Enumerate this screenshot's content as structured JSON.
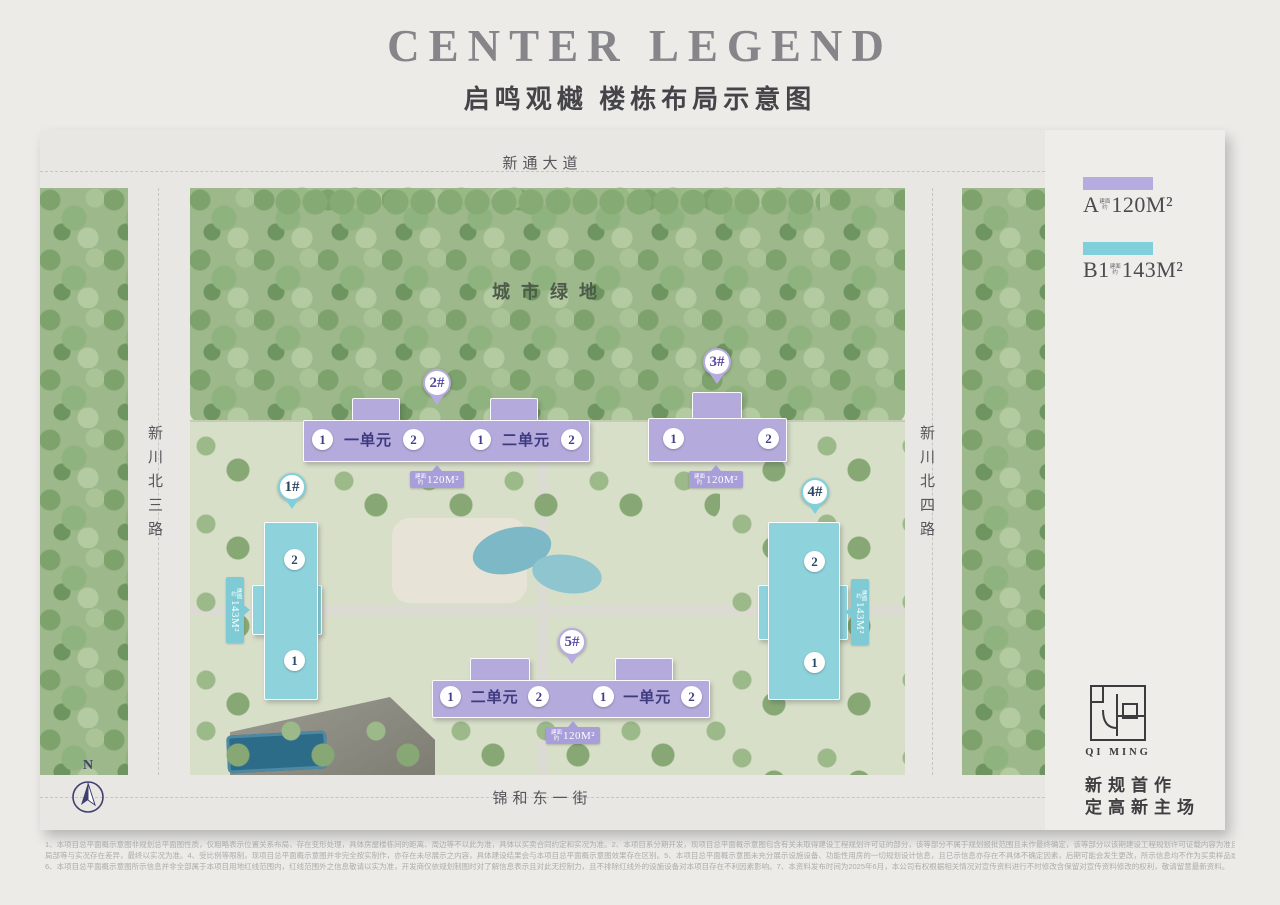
{
  "header": {
    "title": "CENTER LEGEND",
    "subtitle": "启鸣观樾 楼栋布局示意图"
  },
  "roads": {
    "top": "新通大道",
    "left": "新川北三路",
    "right": "新川北四路",
    "bottom": "锦和东一街"
  },
  "map": {
    "green_area_label": "城市绿地",
    "compass": "N"
  },
  "legend": {
    "items": [
      {
        "code": "A",
        "prefix": "建面约",
        "area": "120M²",
        "color": "#b6acdf"
      },
      {
        "code": "B1",
        "prefix": "建面约",
        "area": "143M²",
        "color": "#80cfda"
      }
    ]
  },
  "buildings": {
    "b1": {
      "id": "1#",
      "type": "B1",
      "unit_top": "2",
      "unit_bottom": "1",
      "tag_prefix": "建面约",
      "tag_area": "143M²"
    },
    "b2": {
      "id": "2#",
      "type": "A",
      "cells": [
        "1",
        "一单元",
        "2",
        "1",
        "二单元",
        "2"
      ],
      "tag_prefix": "建面约",
      "tag_area": "120M²"
    },
    "b3": {
      "id": "3#",
      "type": "A",
      "unit_left": "1",
      "unit_right": "2",
      "tag_prefix": "建面约",
      "tag_area": "120M²"
    },
    "b4": {
      "id": "4#",
      "type": "B1",
      "unit_top": "2",
      "unit_bottom": "1",
      "tag_prefix": "建面约",
      "tag_area": "143M²"
    },
    "b5": {
      "id": "5#",
      "type": "A",
      "cells": [
        "1",
        "二单元",
        "2",
        "1",
        "一单元",
        "2"
      ],
      "tag_prefix": "建面约",
      "tag_area": "120M²"
    }
  },
  "branding": {
    "logo_text": "QI MING",
    "slogan_line1": "新规首作",
    "slogan_line2": "定高新主场"
  },
  "disclaimer": {
    "lines": [
      "1、本项目总平面概示意图非规划总平面图性质，仅粗略表示位置关系布局，存在变形处理，具体房屋楼栋间的距离、周边等不以此为准，具体以买卖合同约定和实况为准。2、本项目系分期开发，现项目总平面概示意图包含有关未取得建设工程规划许可证的部分，该等部分不属于规划报批范围且未作最终确定，该等部分以该期建设工程规划许可证载内容为准且项目总平面概示意图亦会发生变化。3、建筑、景观等任何已经展示内容的细节、色彩、",
      "局部等与实况存在差异，最终以实况为准。4、受比例等限制，现项目总平面概示意图并非完全按实制作，亦存在未尽展示之内容，具体建设结果会与本项目总平面概示意图效果存在区别。5、本项目总平面概示意图未充分展示设施设备、功能性用房的一切规划设计信息，且已示信息亦存在不具体不确定因素，后期可能会发生更改，所示信息均不作为买卖样品或要约或承诺，最终交付结果以政府部门核准文件以及双方合同约定内容为准。",
      "6、本项目总平面概示意图所示信息并非全部属于本项目用地红线范围内，红线范围外之信息敬请以实为准，开发商仅依规划制图时对了解信息表示且对此无控制力，且不排除红线外的设施设备对本项目存在不利因素影响。7、本资料发布时间为2025年6月，本公司有权根据相关情况对宣传资料进行不时修改含保留对宣传资料修改的权利，敬请留意最新资料。"
    ]
  },
  "colors": {
    "type_a_purple": "#b4aadc",
    "type_b1_cyan": "#8ed2dc",
    "pin_text_purple": "#5a4b9f",
    "pin_text_cyan": "#2e4663",
    "title_gray": "#86868a",
    "page_background": "#ecebe8"
  }
}
